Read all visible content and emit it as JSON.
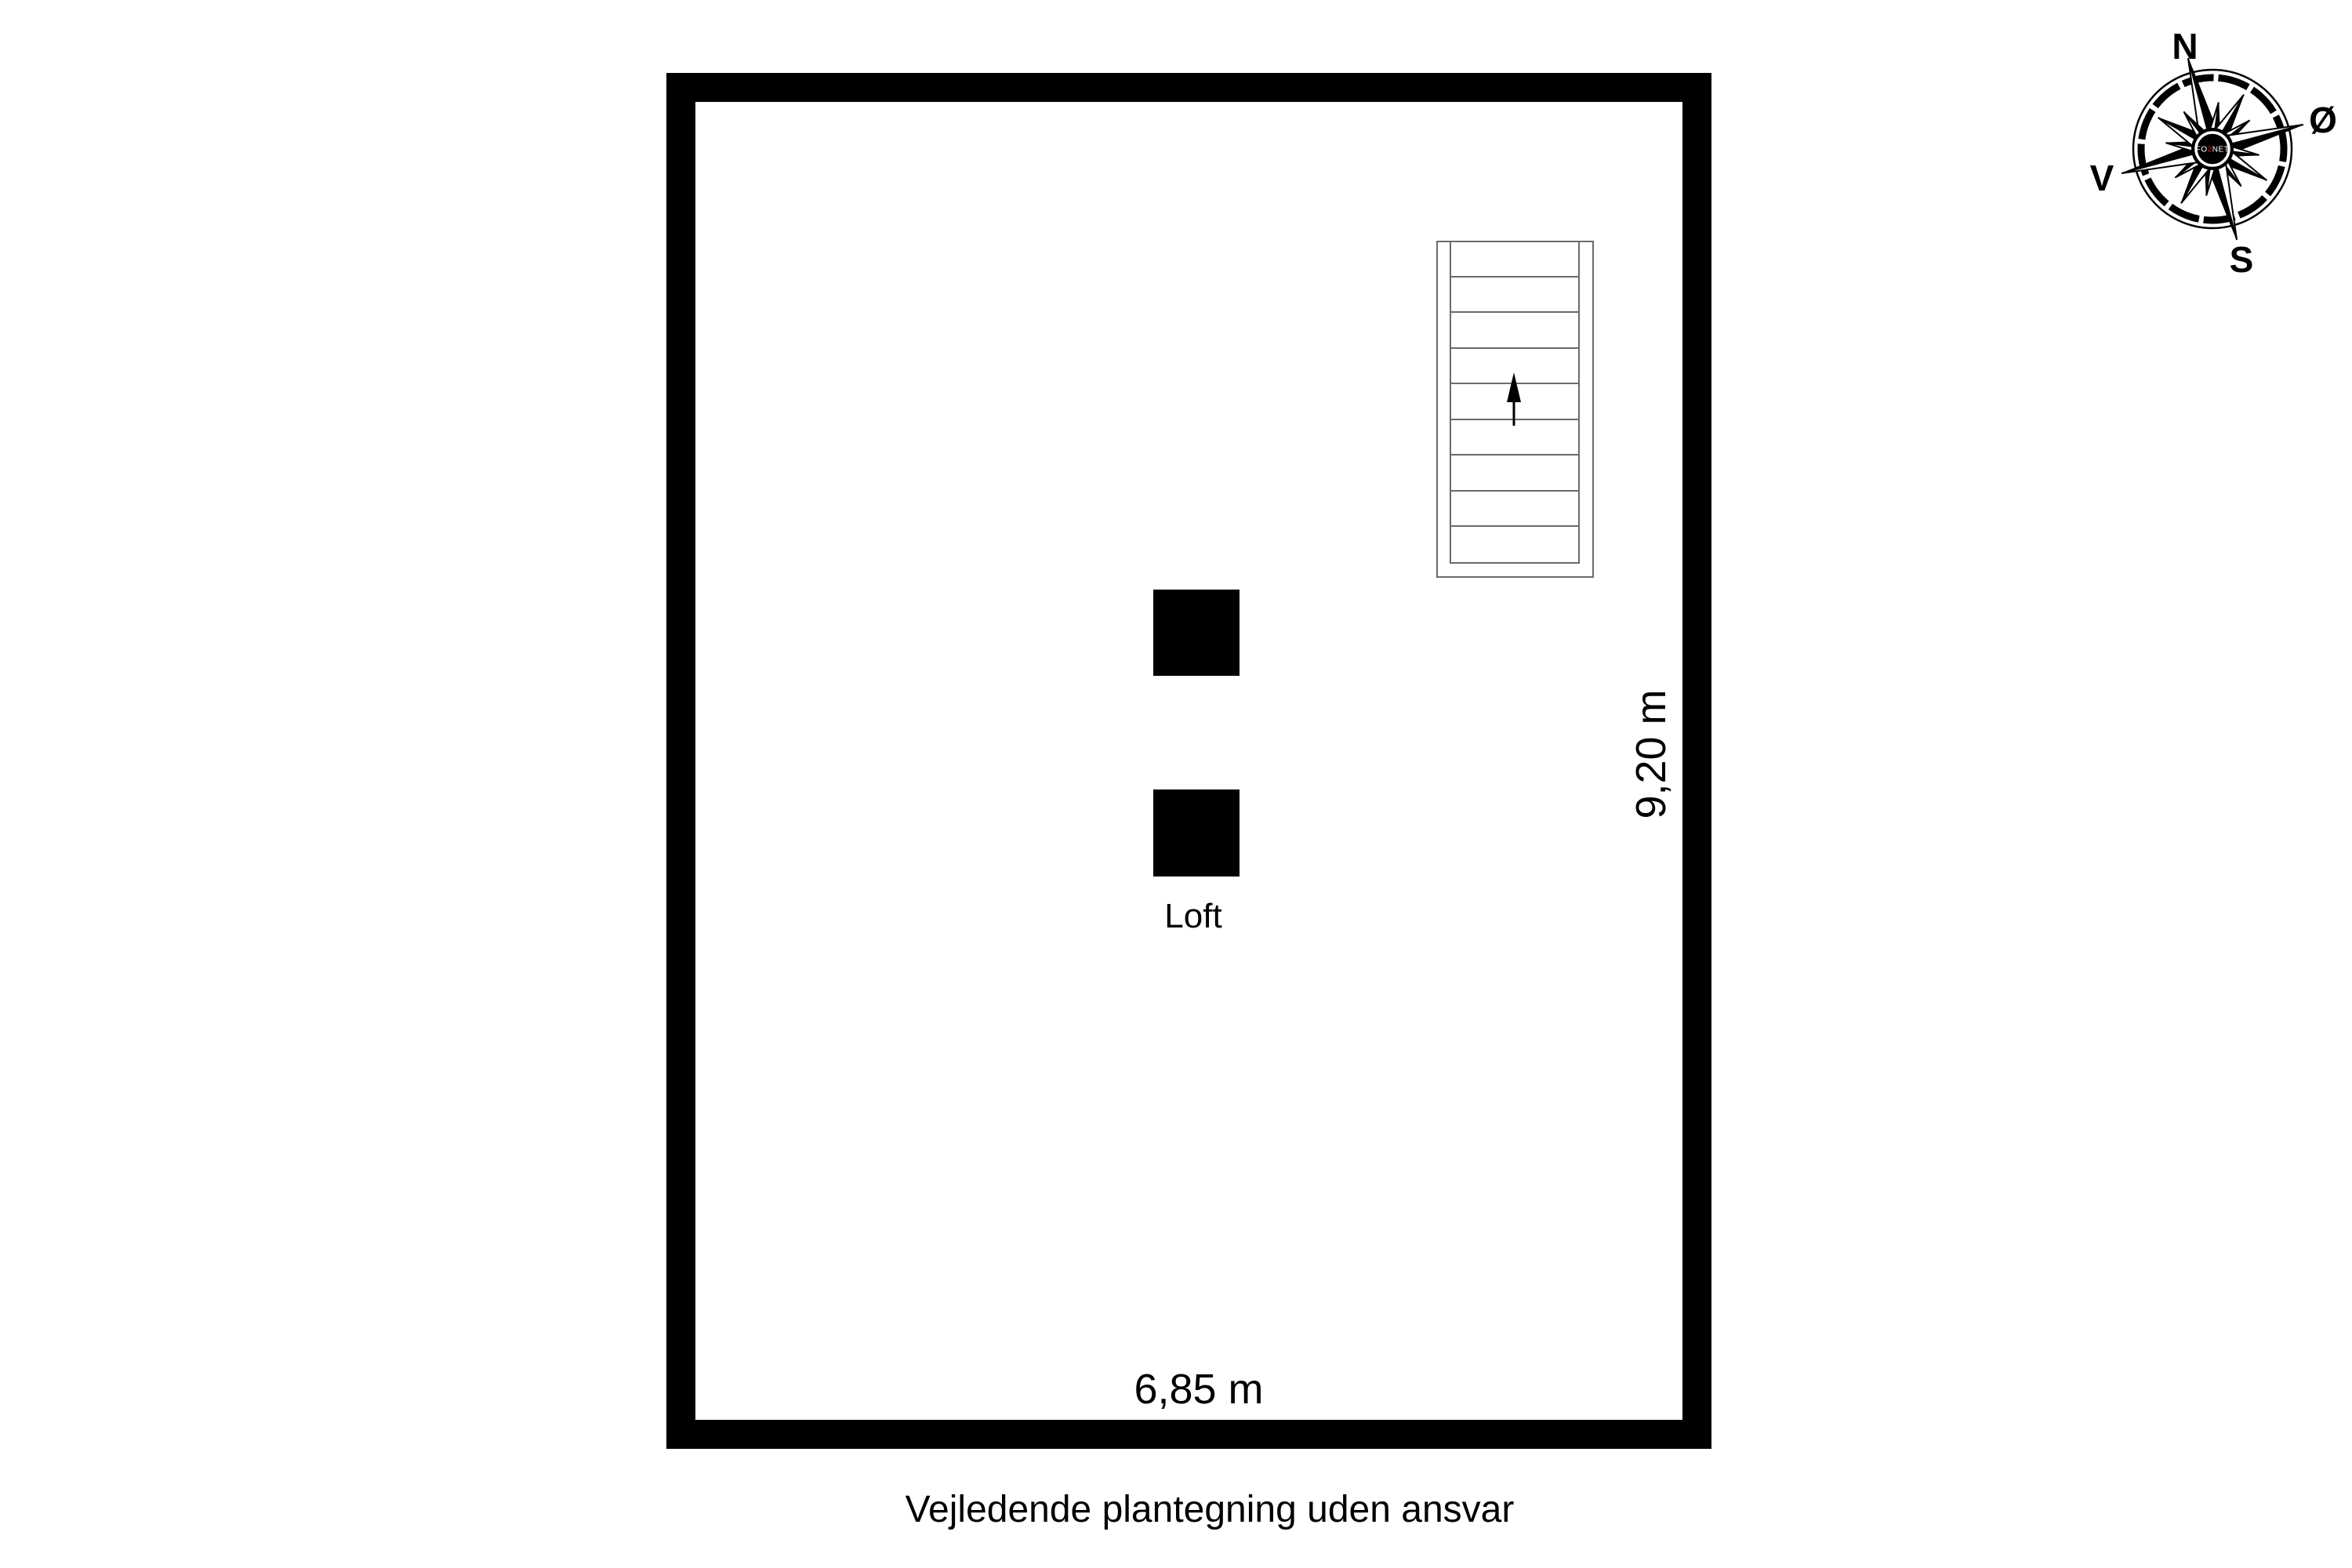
{
  "floor_plan": {
    "room_label": "Loft",
    "width_dimension": "6,85 m",
    "height_dimension": "9,20 m",
    "stairs": {
      "tread_count": 9,
      "arrow_direction": "up"
    },
    "disclaimer": "Vejledende plantegning uden ansvar"
  },
  "compass": {
    "north_label": "N",
    "east_label": "Ø",
    "south_label": "S",
    "west_label": "V",
    "rotation_deg": -15,
    "watermark": {
      "pre": "FO",
      "accent": "2",
      "post": "NET"
    },
    "accent_color": "#cc2222"
  },
  "colors": {
    "background": "#ffffff",
    "wall": "#000000",
    "stair_line": "#6b6b6b",
    "text": "#000000",
    "watermark_accent": "#cc2222"
  }
}
